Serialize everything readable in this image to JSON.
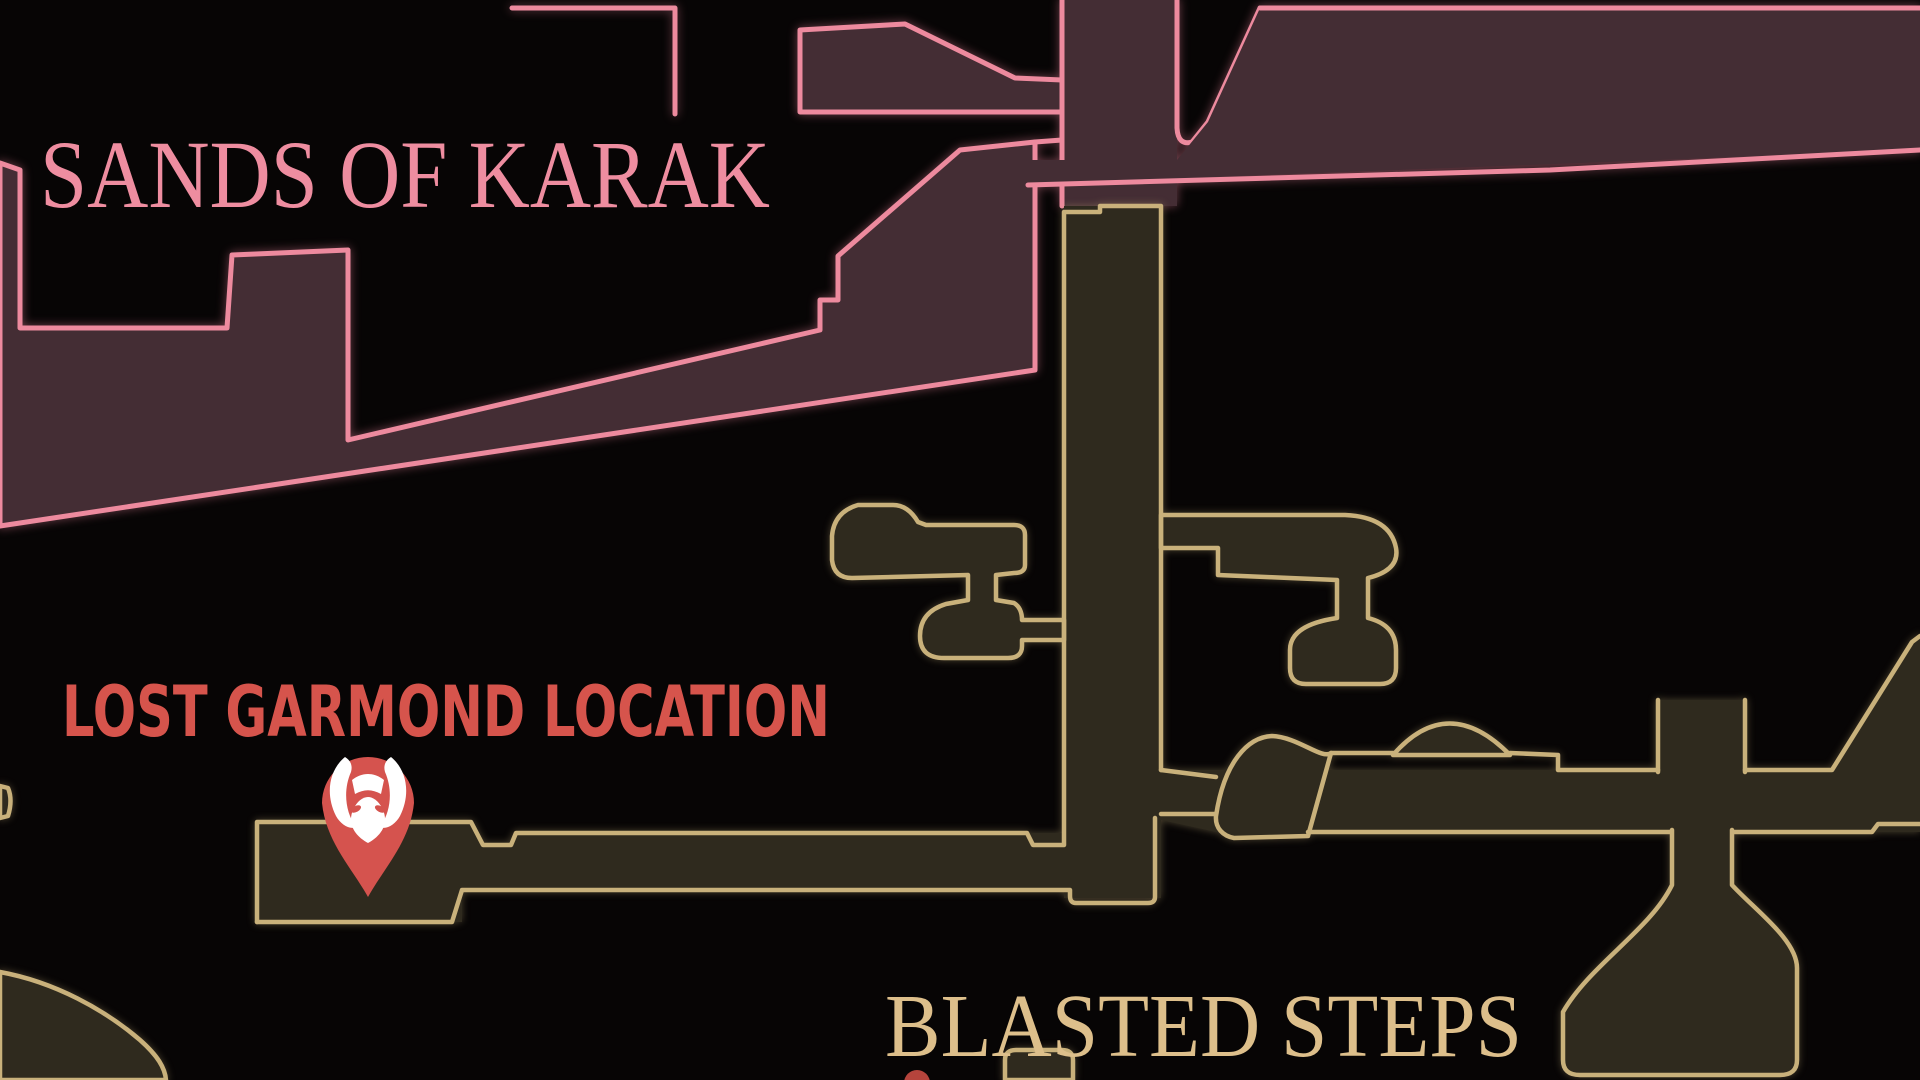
{
  "map": {
    "background_color": "#070505",
    "regions": [
      {
        "id": "sands-of-karak",
        "label": "SANDS OF KARAK",
        "label_color": "#ee8da0",
        "outline_color": "#ed8a9e",
        "fill_color": "#442d34"
      },
      {
        "id": "blasted-steps",
        "label": "BLASTED STEPS",
        "label_color": "#ddbf8b",
        "outline_color": "#c9b17b",
        "fill_color": "#2f2a1e"
      }
    ],
    "marker": {
      "label": "LOST GARMOND LOCATION",
      "label_color": "#d6544c",
      "pin_color": "#d5534e",
      "icon": "beast-face-icon",
      "icon_color": "#ffffff"
    },
    "secondary_marker": {
      "color": "#b5443c"
    }
  }
}
